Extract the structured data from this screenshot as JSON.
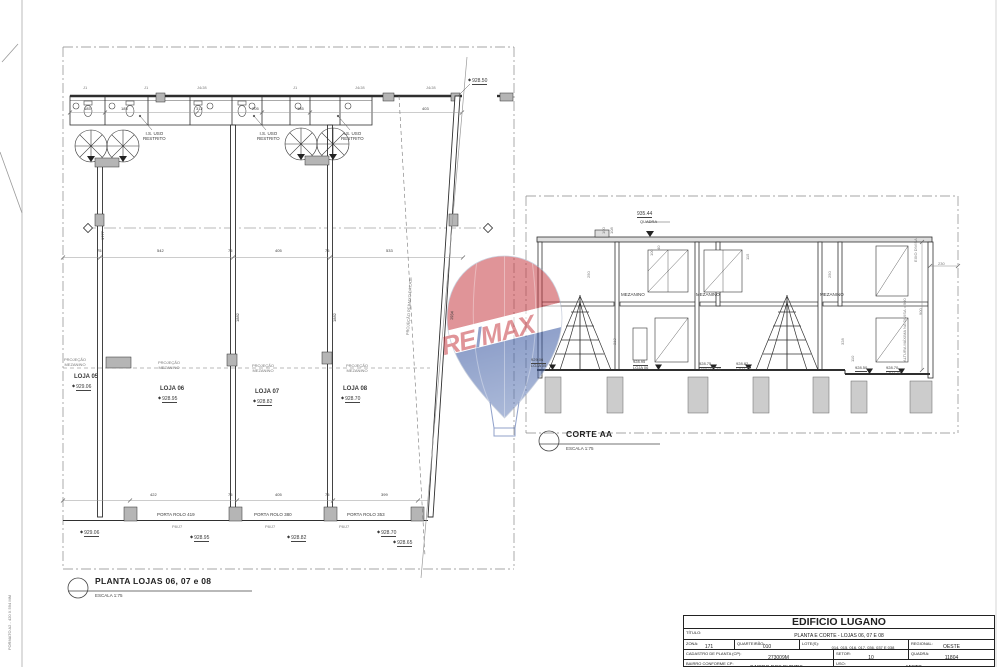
{
  "sheet": {
    "format_label": "FORMATO A2 - 420 X 594 MM"
  },
  "watermark": {
    "brand_left": "RE",
    "brand_slash": "/",
    "brand_right": "MAX",
    "red": "#C4333B",
    "blue": "#2B4C9B"
  },
  "plan": {
    "title": "PLANTA LOJAS 06, 07 e 08",
    "scale": "ESCALA 1:75",
    "tags": {
      "j1": "J1",
      "j48": "J4/J8",
      "p8j7": "P8/J7"
    },
    "is_label": {
      "l1": "I.S. USO",
      "l2": "RESTRITO"
    },
    "proj_mezanino": {
      "l1": "PROJEÇÃO",
      "l2": "MEZANINO"
    },
    "proj_laje": "PROJEÇÃO REBAIXO DA LAJE",
    "lojas": [
      {
        "name": "LOJA 05",
        "level": "929.06"
      },
      {
        "name": "LOJA 06",
        "level": "928.95"
      },
      {
        "name": "LOJA 07",
        "level": "928.82"
      },
      {
        "name": "LOJA 08",
        "level": "928.70"
      }
    ],
    "doors": [
      "PORTA ROLO 419",
      "PORTA ROLO 380",
      "PORTA ROLO 353"
    ],
    "levels": {
      "top_right": "928.50",
      "bottom_right": "928.65"
    },
    "dims_top": [
      "185",
      "185",
      "312",
      "205",
      "185",
      "403"
    ],
    "dims_mid": [
      "75",
      "542",
      "75",
      "405",
      "75",
      "533"
    ],
    "dims_bottom": [
      "422",
      "75",
      "405",
      "75",
      "399"
    ],
    "dims_vert": [
      "1777",
      "1882",
      "1882",
      "1934"
    ]
  },
  "section": {
    "title": "CORTE AA",
    "scale": "ESCALA 1:75",
    "mezzanine": "MEZANINO",
    "top_level": {
      "value": "935.44",
      "label": "QUADRA"
    },
    "floor_levels": [
      {
        "value": "929.06",
        "label": "LOJA 05"
      },
      {
        "value": "928.95",
        "label": "LOJA 06"
      },
      {
        "value": "928.75",
        "label": "MEDIO L.36"
      },
      {
        "value": "928.82",
        "label": "LOJA 07"
      },
      {
        "value": "928.50",
        "label": ""
      },
      {
        "value": "928.70",
        "label": "LOJA 08"
      }
    ],
    "notes": {
      "eixo": "EIXO DIVISA",
      "altura": "ALTURA MÁXIMA NA DIVISA = 900"
    },
    "dims": {
      "d100": "100",
      "d108": "108",
      "d250": "250",
      "d40": "40",
      "d313": "313",
      "d328": "328",
      "d115": "115",
      "d110": "110",
      "d230": "230",
      "d900": "900"
    }
  },
  "titleblock": {
    "building": "EDIFICIO LUGANO",
    "titulo_label": "TÍTULO:",
    "titulo": "PLANTA E CORTE - LOJAS 06, 07 E 08",
    "fields": [
      {
        "label": "ZONA:",
        "value": "171"
      },
      {
        "label": "QUARTEIRÃO:",
        "value": "010"
      },
      {
        "label": "LOTE(S):",
        "value": "014, 015, 016, 017, 036, 037 E 038"
      },
      {
        "label": "REGIONAL:",
        "value": "OESTE"
      },
      {
        "label": "CADASTRO DE PLANTA (CP):",
        "value": "273009M"
      },
      {
        "label": "SETOR:",
        "value": "10"
      },
      {
        "label": "QUADRA:",
        "value": "11804"
      },
      {
        "label": "BAIRRO CONFORME CP:",
        "value": "BAIRRO DOS BURITIS"
      },
      {
        "label": "USO:",
        "value": "MISTO"
      }
    ]
  }
}
